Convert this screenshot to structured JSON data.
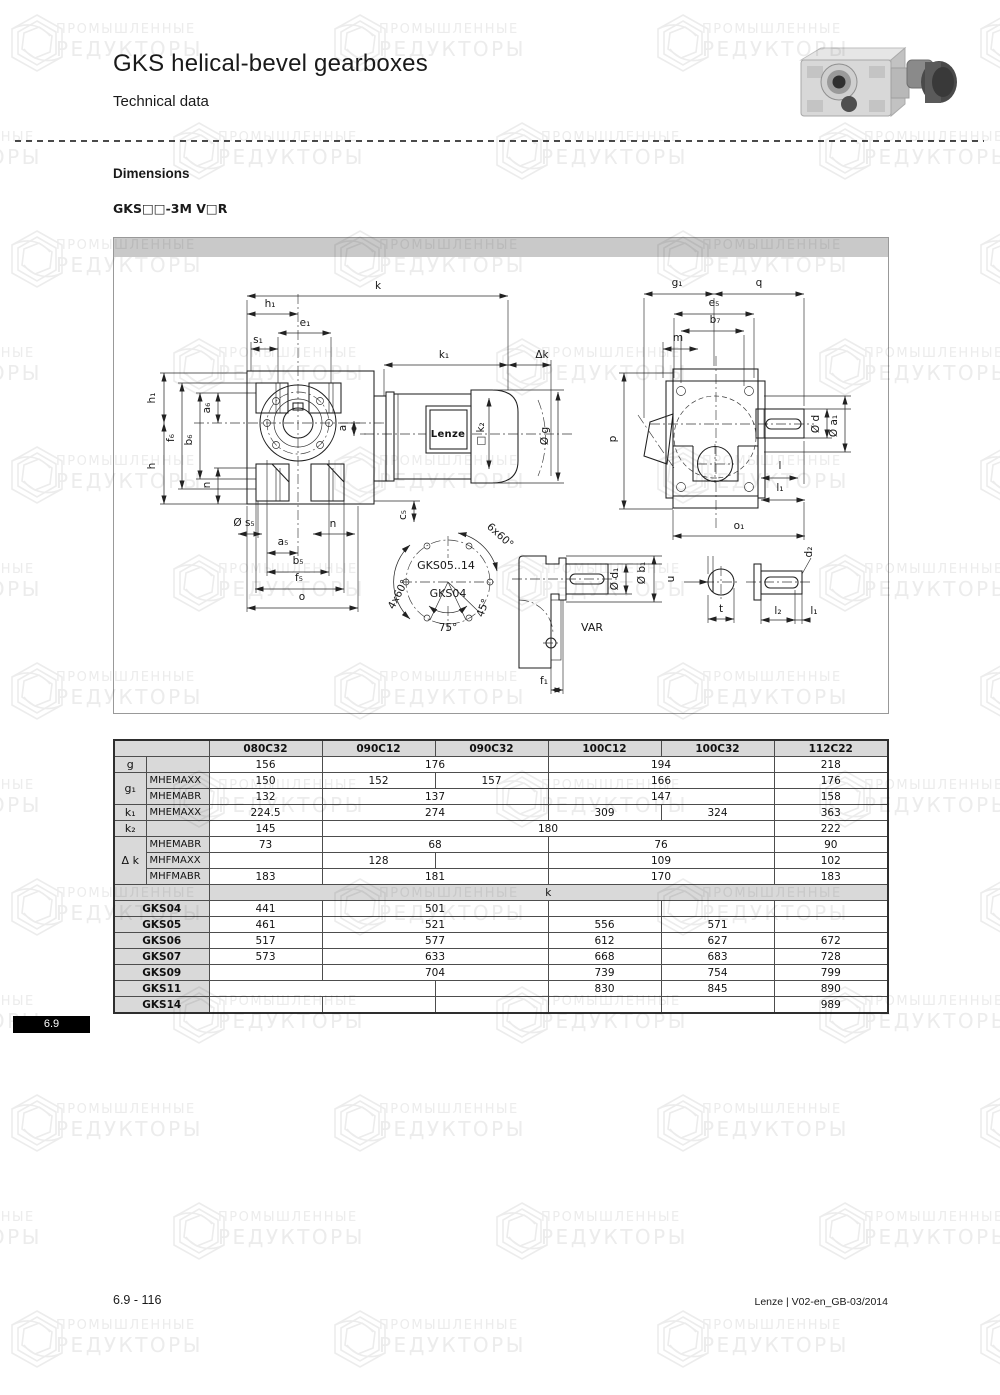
{
  "header": {
    "title": "GKS helical-bevel gearboxes",
    "subtitle": "Technical data"
  },
  "section": {
    "heading": "Dimensions",
    "variant": "GKS□□-3M V□R"
  },
  "watermark": {
    "line1": "ПРОМЫШЛЕННЫЕ",
    "line2": "РЕДУКТОРЫ"
  },
  "tab": {
    "label": "6.9"
  },
  "footer": {
    "left": "6.9 - 116",
    "right": "Lenze | V02-en_GB-03/2014"
  },
  "colors": {
    "table_gray": "#d9d9d9",
    "band_gray": "#c9c9c9",
    "badge_black": "#000000"
  },
  "drawing": {
    "labels": [
      {
        "t": "k",
        "x": 264,
        "y": 51
      },
      {
        "t": "h₁",
        "x": 156,
        "y": 69
      },
      {
        "t": "e₁",
        "x": 191,
        "y": 88
      },
      {
        "t": "s₁",
        "x": 144,
        "y": 105
      },
      {
        "t": "k₁",
        "x": 330,
        "y": 120
      },
      {
        "t": "Δk",
        "x": 428,
        "y": 120
      },
      {
        "t": "h₁",
        "x": 41,
        "y": 160,
        "r": -90
      },
      {
        "t": "f₆",
        "x": 60,
        "y": 200,
        "r": -90
      },
      {
        "t": "b₆",
        "x": 78,
        "y": 202,
        "r": -90
      },
      {
        "t": "a₆",
        "x": 96,
        "y": 170,
        "r": -90
      },
      {
        "t": "h",
        "x": 41,
        "y": 228,
        "r": -90
      },
      {
        "t": "n",
        "x": 96,
        "y": 247,
        "r": -90
      },
      {
        "t": "a",
        "x": 232,
        "y": 190,
        "r": -90
      },
      {
        "t": "□ k₂",
        "x": 370,
        "y": 196,
        "r": -90
      },
      {
        "t": "Ø g",
        "x": 434,
        "y": 198,
        "r": -90
      },
      {
        "t": "c₅",
        "x": 292,
        "y": 277,
        "r": -90
      },
      {
        "t": "Ø s₅",
        "x": 130,
        "y": 288
      },
      {
        "t": "n",
        "x": 219,
        "y": 289
      },
      {
        "t": "a₅",
        "x": 169,
        "y": 307
      },
      {
        "t": "b₅",
        "x": 184,
        "y": 326
      },
      {
        "t": "f₅",
        "x": 185,
        "y": 343
      },
      {
        "t": "o",
        "x": 188,
        "y": 362
      },
      {
        "t": "Lenze",
        "x": 334,
        "y": 199,
        "cls": "brand"
      },
      {
        "t": "GKS05..14",
        "x": 332,
        "y": 331,
        "cls": "med"
      },
      {
        "t": "GKS04",
        "x": 334,
        "y": 359,
        "cls": "med"
      },
      {
        "t": "6x60°",
        "x": 384,
        "y": 300,
        "r": 42
      },
      {
        "t": "4x60°",
        "x": 287,
        "y": 358,
        "r": -62
      },
      {
        "t": "75°",
        "x": 334,
        "y": 393
      },
      {
        "t": "45°",
        "x": 372,
        "y": 371,
        "r": -70
      },
      {
        "t": "VAR",
        "x": 478,
        "y": 393,
        "cls": "med"
      },
      {
        "t": "Ø d₁",
        "x": 504,
        "y": 341,
        "r": -90
      },
      {
        "t": "Ø b₁",
        "x": 531,
        "y": 335,
        "r": -90
      },
      {
        "t": "f₁",
        "x": 430,
        "y": 446
      },
      {
        "t": "u",
        "x": 560,
        "y": 341,
        "r": -90
      },
      {
        "t": "t",
        "x": 607,
        "y": 374
      },
      {
        "t": "l₂",
        "x": 664,
        "y": 376
      },
      {
        "t": "l₁",
        "x": 700,
        "y": 376
      },
      {
        "t": "d₂",
        "x": 698,
        "y": 314,
        "r": -90
      },
      {
        "t": "g₁",
        "x": 563,
        "y": 48
      },
      {
        "t": "q",
        "x": 645,
        "y": 48
      },
      {
        "t": "e₅",
        "x": 600,
        "y": 68
      },
      {
        "t": "b₇",
        "x": 601,
        "y": 85
      },
      {
        "t": "m",
        "x": 564,
        "y": 103
      },
      {
        "t": "p",
        "x": 502,
        "y": 201,
        "r": -90
      },
      {
        "t": "Ø d",
        "x": 705,
        "y": 186,
        "r": -90
      },
      {
        "t": "Ø a₁",
        "x": 723,
        "y": 188,
        "r": -90
      },
      {
        "t": "l",
        "x": 666,
        "y": 231
      },
      {
        "t": "l₁",
        "x": 666,
        "y": 253
      },
      {
        "t": "o₁",
        "x": 625,
        "y": 291
      }
    ]
  },
  "table": {
    "columns": [
      "080C32",
      "090C12",
      "090C32",
      "100C12",
      "100C32",
      "112C22"
    ],
    "rows": [
      {
        "first": {
          "t": "g",
          "rs": 1
        },
        "second": "",
        "cells": [
          [
            "156",
            1
          ],
          [
            "176",
            2
          ],
          [
            "194",
            2
          ],
          [
            "218",
            1
          ]
        ]
      },
      {
        "first": {
          "t": "g₁",
          "rs": 2
        },
        "second": "MHEMAXX",
        "cells": [
          [
            "150",
            1
          ],
          [
            "152",
            1
          ],
          [
            "157",
            1
          ],
          [
            "166",
            2
          ],
          [
            "176",
            1
          ]
        ]
      },
      {
        "second": "MHEMABR",
        "cells": [
          [
            "132",
            1
          ],
          [
            "137",
            2
          ],
          [
            "147",
            2
          ],
          [
            "158",
            1
          ]
        ]
      },
      {
        "first": {
          "t": "k₁",
          "rs": 1
        },
        "second": "MHEMAXX",
        "cells": [
          [
            "224.5",
            1
          ],
          [
            "274",
            2
          ],
          [
            "309",
            1
          ],
          [
            "324",
            1
          ],
          [
            "363",
            1
          ]
        ]
      },
      {
        "first": {
          "t": "k₂",
          "rs": 1
        },
        "second": "",
        "cells": [
          [
            "145",
            1
          ],
          [
            "180",
            4
          ],
          [
            "222",
            1
          ]
        ]
      },
      {
        "first": {
          "t": "Δ k",
          "rs": 3
        },
        "second": "MHEMABR",
        "cells": [
          [
            "73",
            1
          ],
          [
            "68",
            2
          ],
          [
            "76",
            2
          ],
          [
            "90",
            1
          ]
        ]
      },
      {
        "second": "MHFMAXX",
        "cells": [
          [
            "",
            1
          ],
          [
            "128",
            1
          ],
          [
            "",
            1
          ],
          [
            "109",
            2
          ],
          [
            "102",
            1
          ]
        ]
      },
      {
        "second": "MHFMABR",
        "cells": [
          [
            "183",
            1
          ],
          [
            "181",
            2
          ],
          [
            "170",
            2
          ],
          [
            "183",
            1
          ]
        ]
      },
      {
        "section": "k"
      },
      {
        "gks": "GKS04",
        "cells": [
          [
            "441",
            1
          ],
          [
            "501",
            2
          ],
          [
            "",
            1
          ],
          [
            "",
            1
          ],
          [
            "",
            1
          ]
        ]
      },
      {
        "gks": "GKS05",
        "cells": [
          [
            "461",
            1
          ],
          [
            "521",
            2
          ],
          [
            "556",
            1
          ],
          [
            "571",
            1
          ],
          [
            "",
            1
          ]
        ]
      },
      {
        "gks": "GKS06",
        "cells": [
          [
            "517",
            1
          ],
          [
            "577",
            2
          ],
          [
            "612",
            1
          ],
          [
            "627",
            1
          ],
          [
            "672",
            1
          ]
        ]
      },
      {
        "gks": "GKS07",
        "cells": [
          [
            "573",
            1
          ],
          [
            "633",
            2
          ],
          [
            "668",
            1
          ],
          [
            "683",
            1
          ],
          [
            "728",
            1
          ]
        ]
      },
      {
        "gks": "GKS09",
        "cells": [
          [
            "",
            1
          ],
          [
            "704",
            2
          ],
          [
            "739",
            1
          ],
          [
            "754",
            1
          ],
          [
            "799",
            1
          ]
        ]
      },
      {
        "gks": "GKS11",
        "cells": [
          [
            "",
            2
          ],
          [
            "",
            1
          ],
          [
            "830",
            1
          ],
          [
            "845",
            1
          ],
          [
            "890",
            1
          ]
        ]
      },
      {
        "gks": "GKS14",
        "cells": [
          [
            "",
            1
          ],
          [
            "",
            1
          ],
          [
            "",
            1
          ],
          [
            "",
            1
          ],
          [
            "",
            1
          ],
          [
            "989",
            1
          ]
        ]
      }
    ]
  }
}
